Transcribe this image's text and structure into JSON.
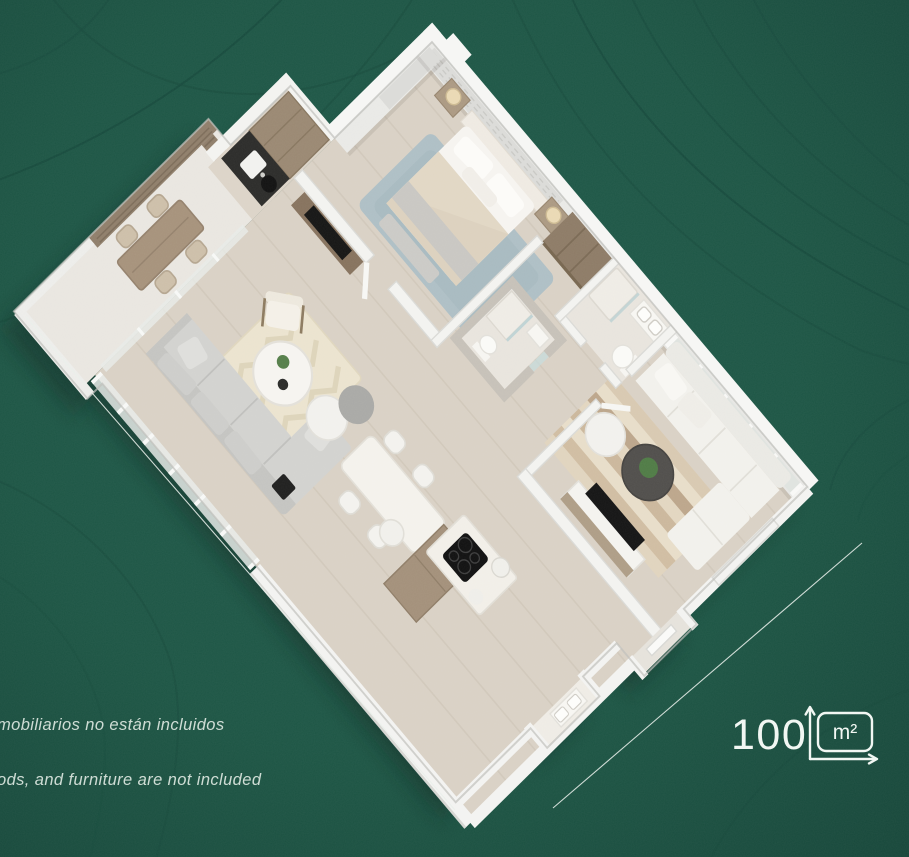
{
  "canvas": {
    "width": 909,
    "height": 857
  },
  "background": {
    "base_color": "#1D5645",
    "vignette_color": "#17473A",
    "contour_color": "#174A3C"
  },
  "decor": {
    "diagonal_line_color": "#EAF0EB"
  },
  "disclaimer": {
    "line_es": "mobiliarios no están incluidos",
    "line_en": "ods, and furniture are not included",
    "text_color": "#DCE7E0"
  },
  "area_badge": {
    "value": "100",
    "unit": "m²",
    "color": "#F2F7F3"
  },
  "floor_plan": {
    "shadow_color": "#0B241C",
    "wall_color": "#F3F3F0",
    "floor_wood": "#D9D1C5",
    "floor_tile": "#E8E4DD",
    "terrace_floor": "#E9E6E0",
    "curtain_color": "#DBDBD8",
    "wood_dark": "#86725D",
    "wood_mid": "#A3907A",
    "counter_black": "#2B2B29",
    "tv_black": "#141414",
    "sofa_gray": "#D2D2CF",
    "sofa_white": "#F2F1EC",
    "rug_blue": "#AEBFC5",
    "rug_chevron": "#EBE3CF",
    "rug_stripe_dark": "#BCA68B",
    "plant_green": "#4F7B45"
  }
}
